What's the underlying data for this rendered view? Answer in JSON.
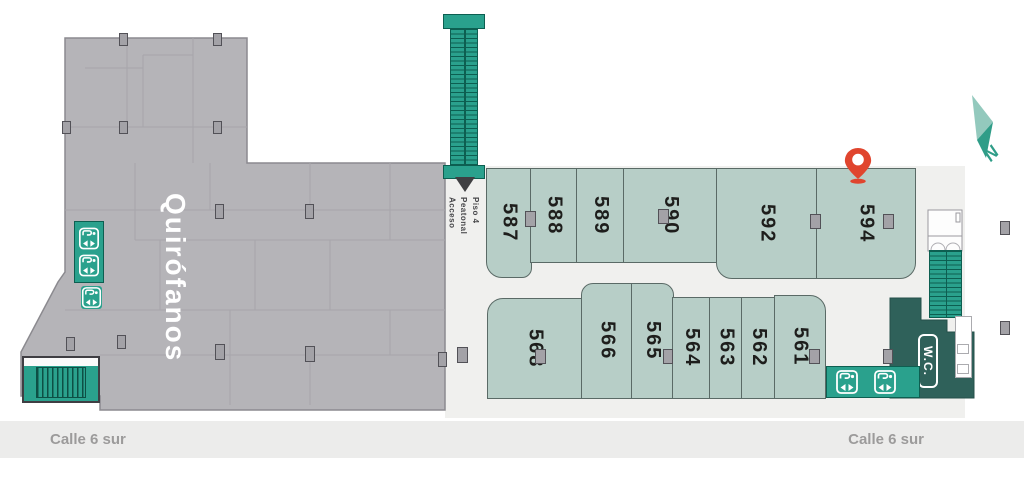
{
  "building": {
    "label": "Quirófanos"
  },
  "access": {
    "label": "Acceso\nPeatonal\nPiso 4"
  },
  "wc": {
    "label": "W.C."
  },
  "compass": {
    "label": "N"
  },
  "streets": {
    "left": "Calle 6 sur",
    "right": "Calle 6 sur"
  },
  "rooms": {
    "upper": [
      "587",
      "588",
      "589",
      "590",
      "592",
      "594"
    ],
    "lower": [
      "568",
      "566",
      "565",
      "564",
      "563",
      "562",
      "561"
    ]
  },
  "pin": {
    "room": "594"
  },
  "icons": {
    "escalator_top": "escalator-icon",
    "stairs_bottom_left": "stairs-icon",
    "stairs_right": "stairs-icon",
    "elevators_left": "elevator-icon",
    "elevators_bottom_right": "elevator-icon",
    "pedestrian_access": "down-triangle-icon",
    "location_pin": "map-pin-icon",
    "compass_north": "north-arrow-icon"
  },
  "colors": {
    "room_fill": "#b7cec7",
    "room_border": "#5a6a66",
    "building_gray": "#b5b4b8",
    "corridor": "#f0f0ee",
    "teal": "#2aa18d",
    "teal_dark": "#0d5f51",
    "wc_area": "#2f615a",
    "pin_red": "#e0452e",
    "street_band": "#ececeb",
    "street_text": "#9c9b9b"
  }
}
